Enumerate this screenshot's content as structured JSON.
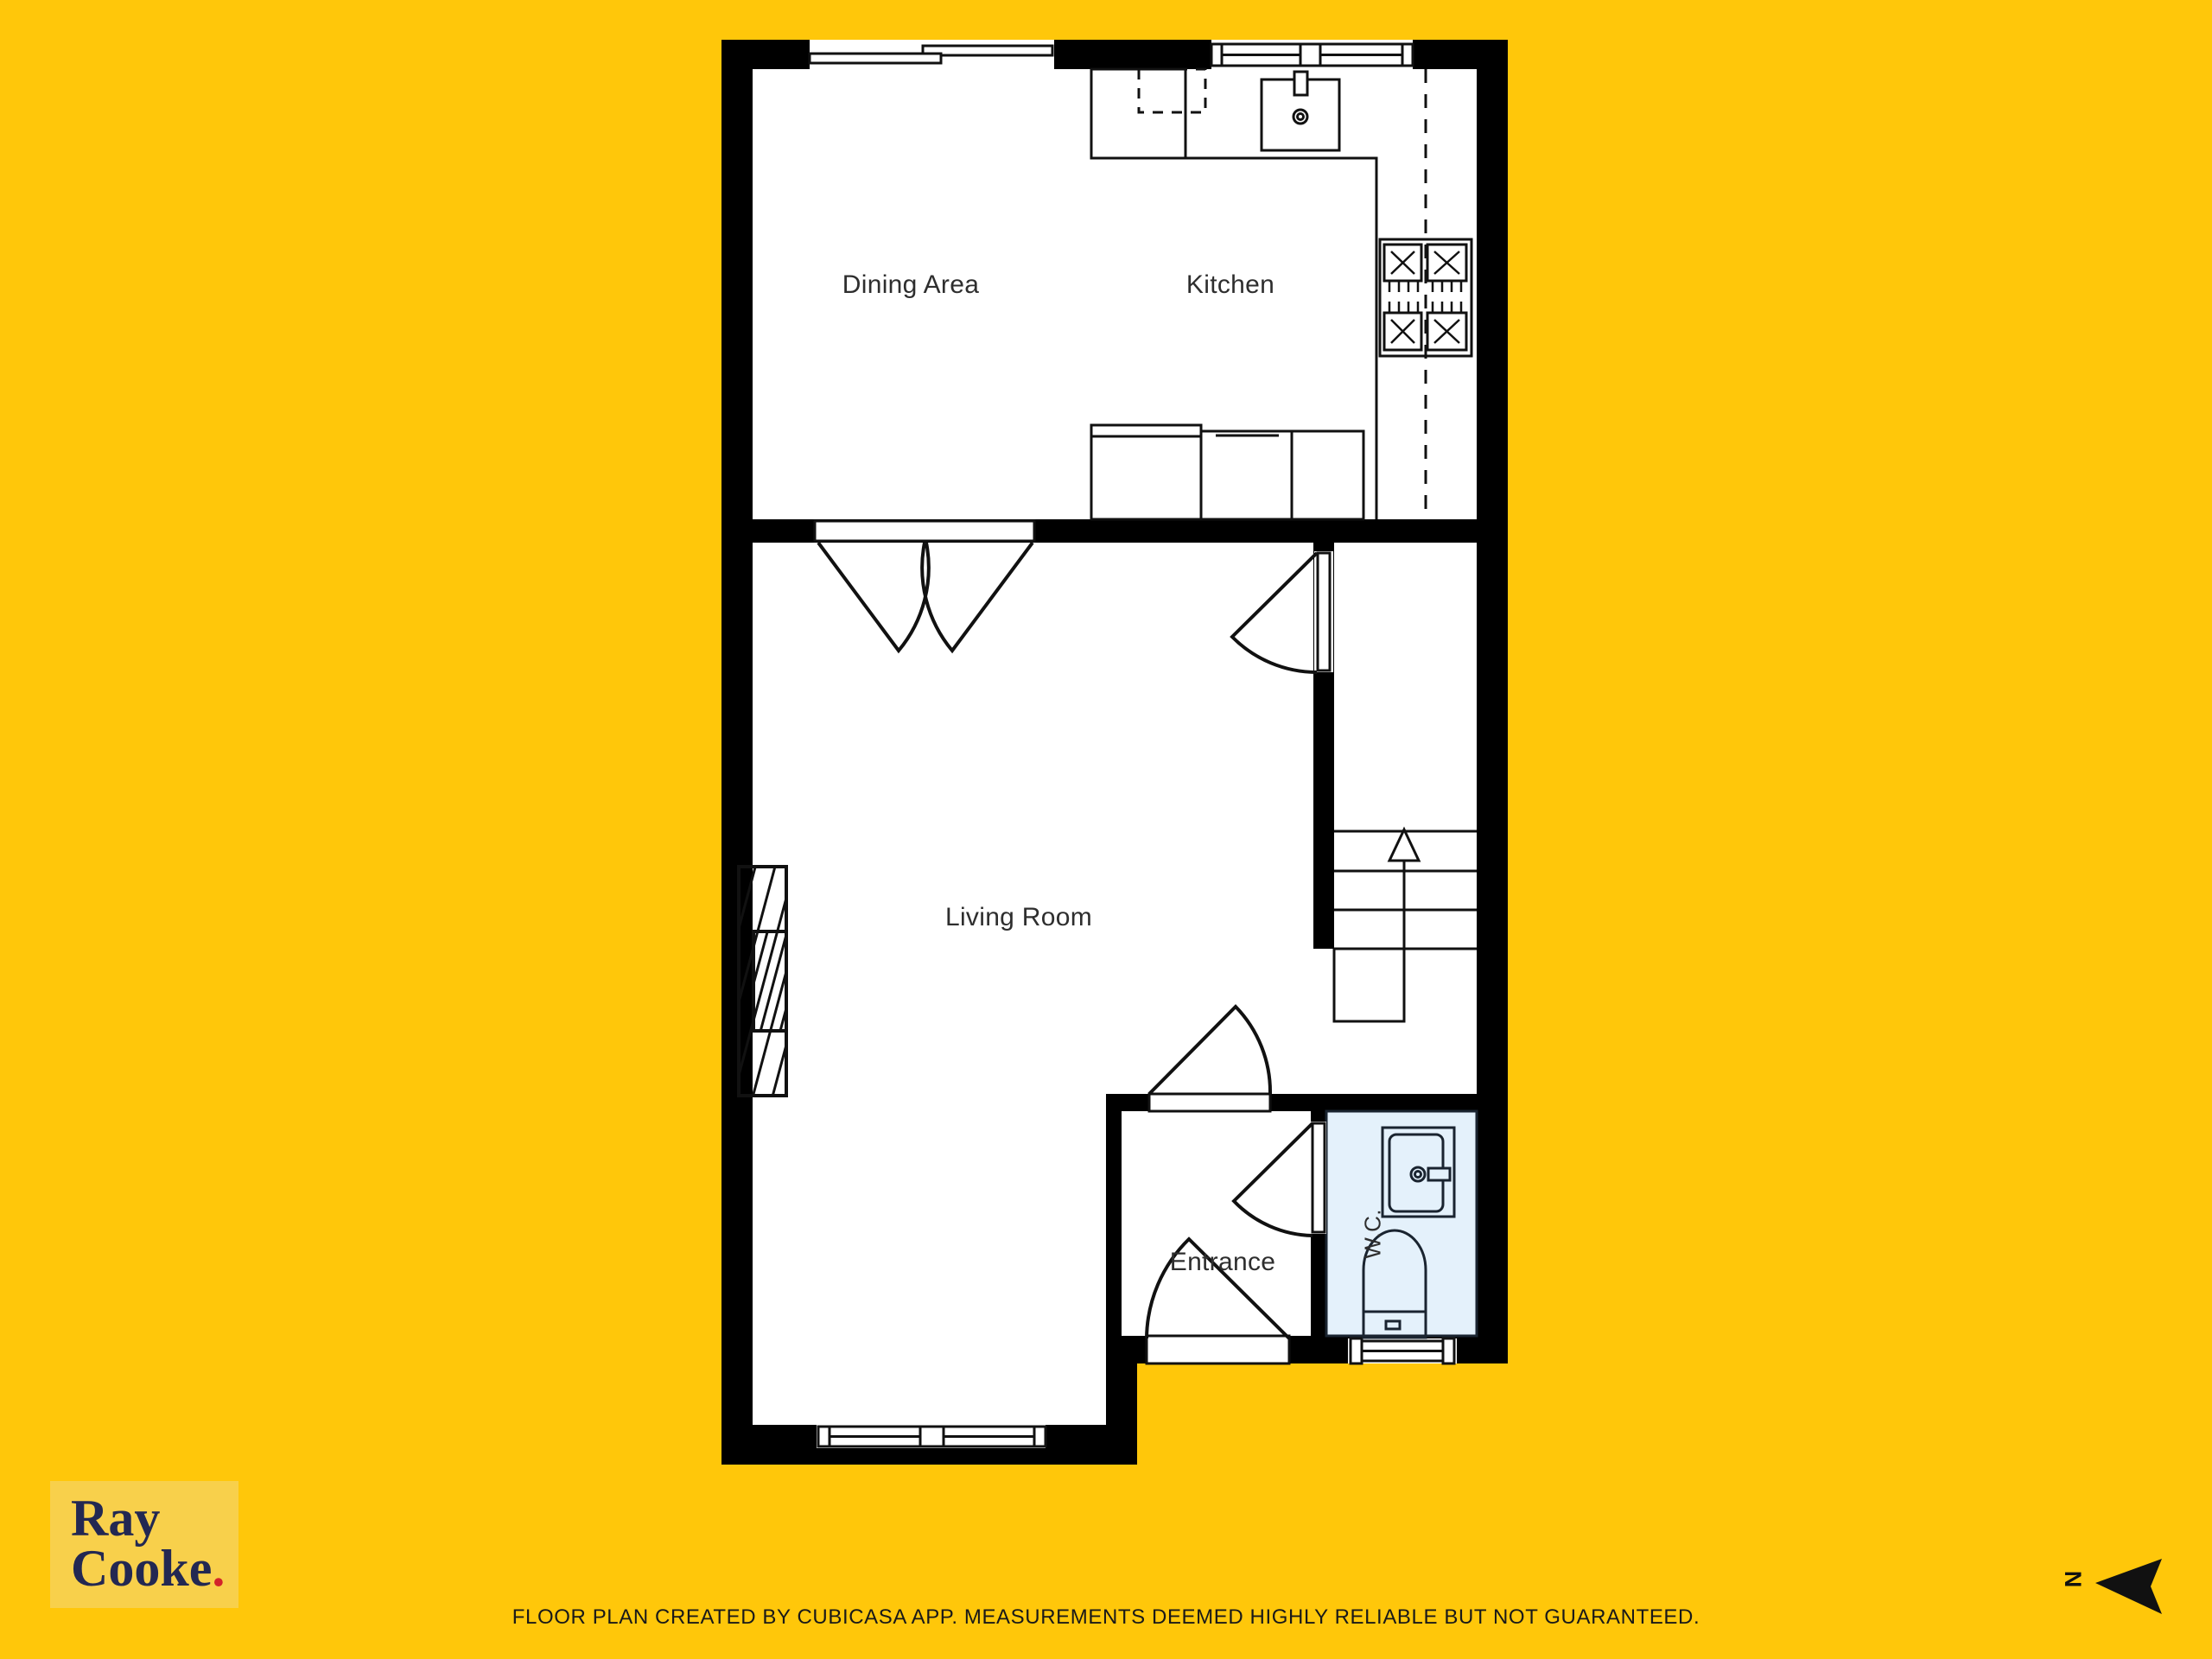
{
  "plan": {
    "room_labels": {
      "dining_area": "Dining Area",
      "kitchen": "Kitchen",
      "living_room": "Living Room",
      "entrance": "Entrance",
      "wc": "W.C."
    }
  },
  "branding": {
    "logo_line1": "Ray",
    "logo_line2": "Cooke",
    "logo_dot": "."
  },
  "compass": {
    "north_label": "N"
  },
  "footer": {
    "disclaimer": "FLOOR PLAN CREATED BY CUBICASA APP. MEASUREMENTS DEEMED HIGHLY RELIABLE BUT NOT GUARANTEED."
  },
  "colors": {
    "background": "#FFC70A",
    "logo_box": "#F8D04B",
    "logo_text": "#232852",
    "logo_dot": "#D2232A",
    "wall": "#000000",
    "floor": "#FFFFFF",
    "wc_room_fill": "#E4F1FB",
    "line": "#111111",
    "label_text": "#2E2E2E"
  }
}
